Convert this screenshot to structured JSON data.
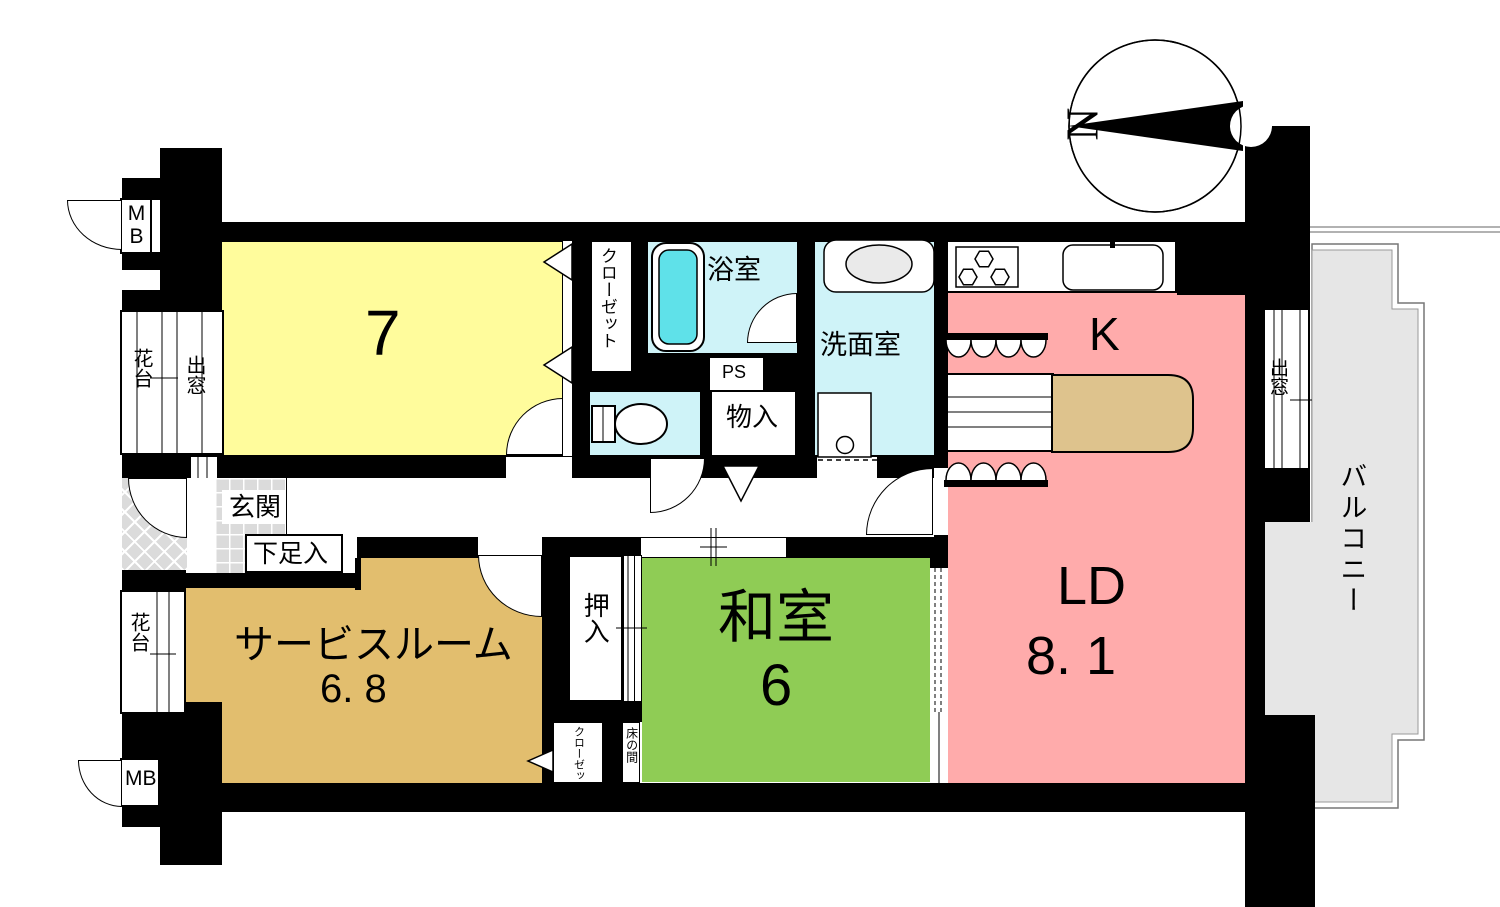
{
  "plan": {
    "compass": {
      "north": "N"
    },
    "rooms": {
      "bedroom7": {
        "label": "7"
      },
      "closet_top": {
        "label": "クローゼット"
      },
      "bath": {
        "label": "浴室"
      },
      "pipe_space": {
        "label": "PS"
      },
      "storage": {
        "label": "物入"
      },
      "washroom": {
        "label": "洗面室"
      },
      "kitchen": {
        "label": "K"
      },
      "living_dining": {
        "label": "LD",
        "size": "8. 1"
      },
      "japanese_room": {
        "label": "和室",
        "size": "6"
      },
      "service_room": {
        "label": "サービスルーム",
        "size": "6. 8"
      },
      "oshiire": {
        "label": "押入"
      },
      "closet_bottom": {
        "label": "クローゼット"
      },
      "tokonoma": {
        "label": "床の間"
      },
      "entrance": {
        "label": "玄関"
      },
      "shoe_cabinet": {
        "label": "下足入"
      },
      "balcony": {
        "label": "バルコニー"
      },
      "meter_box_top": {
        "label": "MB"
      },
      "meter_box_bottom": {
        "label": "MB"
      },
      "flower_stand_top": {
        "label": "花台"
      },
      "flower_stand_bottom": {
        "label": "花台"
      },
      "bay_window_left": {
        "label": "出窓"
      },
      "bay_window_right": {
        "label": "出窓"
      }
    },
    "colors": {
      "bedroom": "#FFFC9C",
      "water_rooms": "#CFF3F8",
      "bathtub": "#5FE1E9",
      "kitchen_living": "#FFABAB",
      "tatami": "#8FCC55",
      "service_room": "#E2BE6E",
      "table": "#DEC38D",
      "balcony": "#E6E6E6",
      "tile": "#DBDBDB",
      "wall": "#000000"
    }
  }
}
